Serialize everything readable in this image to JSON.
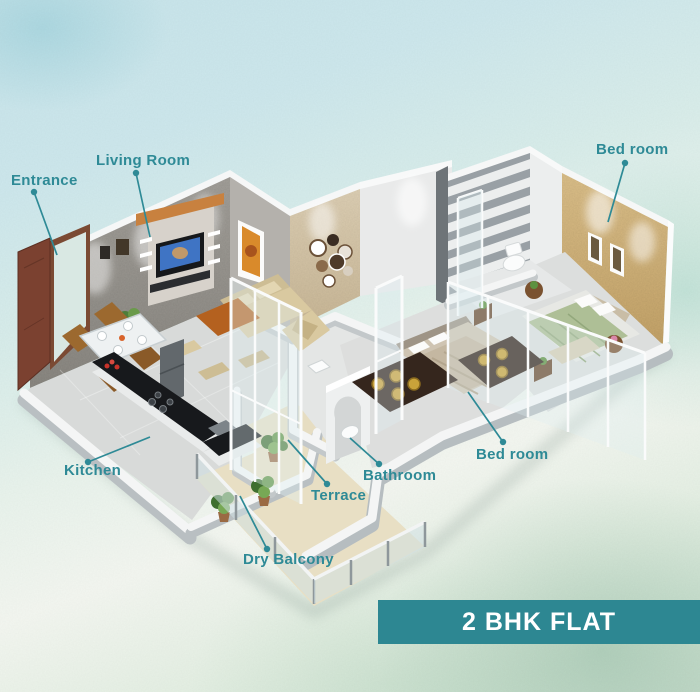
{
  "poster_title": "2 BHK flat isometric floor plan",
  "banner": {
    "title": "2 BHK FLAT"
  },
  "colors": {
    "label": "#2e8a96",
    "banner_bg": "#2d8792",
    "banner_text": "#ffffff"
  },
  "labels": {
    "entrance": "Entrance",
    "living_room": "Living Room",
    "bedroom_top": "Bed room",
    "kitchen": "Kitchen",
    "terrace": "Terrace",
    "bathroom": "Bathroom",
    "bedroom_bottom": "Bed room",
    "dry_balcony": "Dry Balcony"
  }
}
